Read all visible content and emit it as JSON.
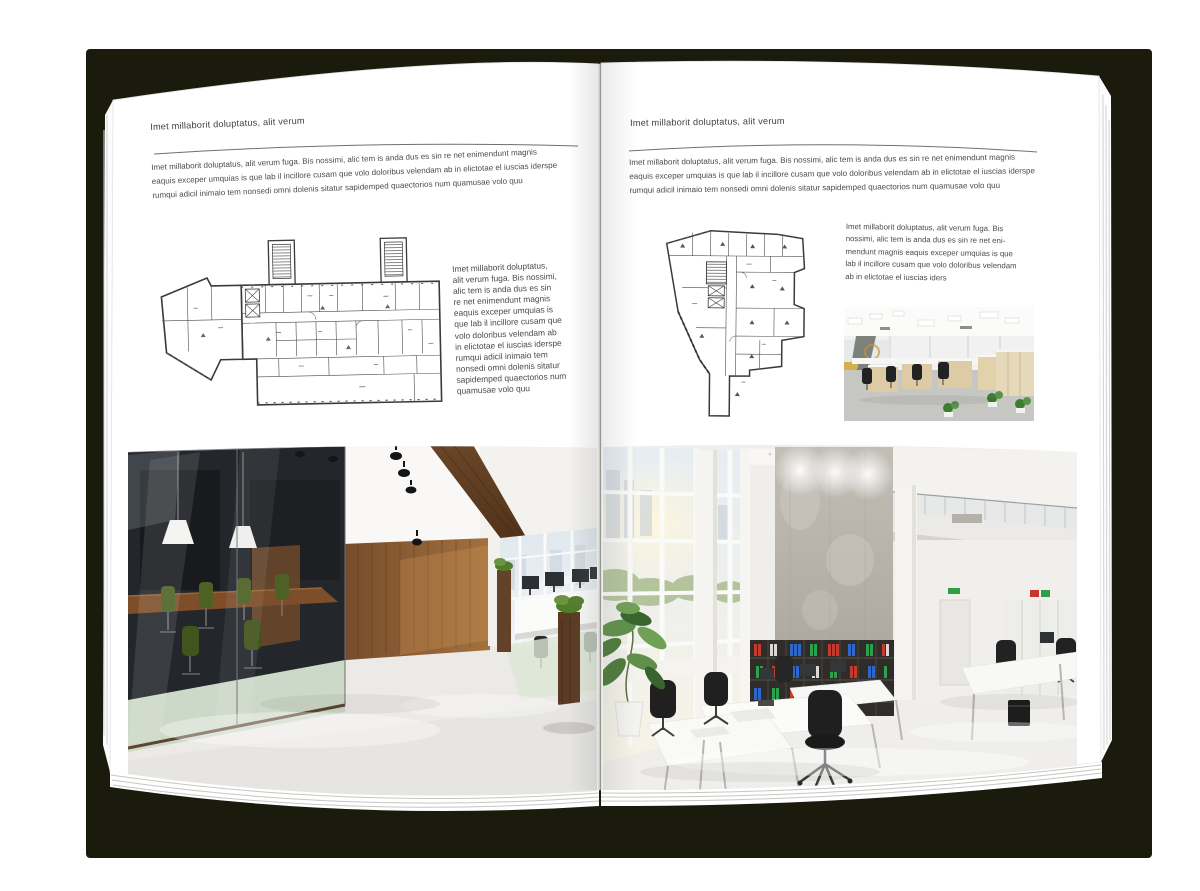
{
  "document": {
    "type": "magazine-spread-mockup",
    "left_page": {
      "header": "Imet millaborit doluptatus, alit verum",
      "intro_lines": [
        "Imet millaborit doluptatus, alit verum fuga. Bis nossimi, alic tem is anda dus es sin re net enimendunt magnis",
        "eaquis exceper umquias is que lab il incillore cusam que volo doloribus velendam ab in elictotae el iuscias iderspe",
        "rumqui adicil inimaio tem nonsedi omni dolenis sitatur sapidemped quaectorios num quamusae volo quu"
      ],
      "side_text_lines": [
        "Imet millaborit doluptatus,",
        "alit verum fuga. Bis nossimi,",
        "alic tem is anda dus es sin",
        "re net enimendunt magnis",
        "eaquis exceper umquias is",
        "que lab il incillore cusam que",
        "volo doloribus velendam ab",
        "in elictotae el iuscias iderspe",
        "rumqui adicil inimaio tem",
        "nonsedi omni dolenis sitatur",
        "sapidemped quaectorios num",
        "quamusae volo quu"
      ]
    },
    "right_page": {
      "header": "Imet millaborit doluptatus, alit verum",
      "intro_lines": [
        "Imet millaborit doluptatus, alit verum fuga. Bis nossimi, alic tem is anda dus es sin re net enimendunt magnis",
        "eaquis exceper umquias is que lab il incillore cusam que volo doloribus velendam ab in elictotae el iuscias iderspe",
        "rumqui adicil inimaio tem nonsedi omni dolenis sitatur sapidemped quaectorios num quamusae volo quu"
      ],
      "side_text_lines": [
        "Imet millaborit doluptatus, alit verum fuga. Bis",
        "nossimi, alic tem is anda dus es sin re net eni-",
        "mendunt magnis eaquis exceper umquias is que",
        "lab il incillore cusam que volo doloribus velendam",
        "ab in elictotae el iuscias iders"
      ]
    }
  },
  "figures": {
    "left_floor_plan": "architectural-floor-plan-wide-building",
    "right_floor_plan": "architectural-floor-plan-irregular-tower",
    "left_photo": "dark-wood-office-interior-photo",
    "right_photo": "bright-white-office-interior-photo",
    "small_photo": "open-plan-office-workstations-photo"
  },
  "colors": {
    "backdrop": "#1a1b0c",
    "page": "#ffffff",
    "heading_text": "#3f3f3f",
    "body_text": "#4a4a4a",
    "rule_line": "#6f6f6f",
    "plan_ink": "#3a3a3a",
    "wood_accent": "#7c5533",
    "chair_green": "#4d6125",
    "plant_green": "#4a7a38",
    "binder_red": "#c23b2c",
    "binder_blue": "#2e66c9",
    "binder_green": "#2aa14a"
  }
}
